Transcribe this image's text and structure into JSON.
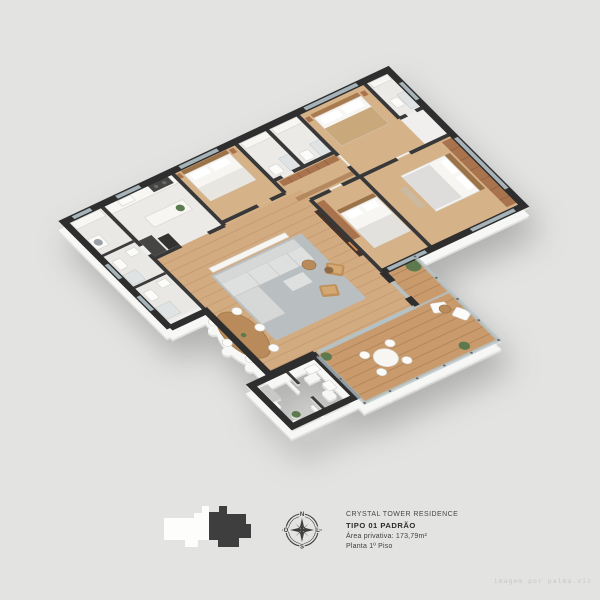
{
  "info": {
    "project": "CRYSTAL TOWER RESIDENCE",
    "unit_type": "TIPO 01 PADRÃO",
    "area": "Área privativa: 173,79m²",
    "floor": "Planta 1º Piso"
  },
  "compass": {
    "north": "N",
    "east": "L",
    "south": "S",
    "west": "O"
  },
  "watermark": "imagem por palma.viz",
  "icons": [
    "keyplan-icon",
    "compass-rose-icon"
  ],
  "palette": {
    "background": "#e3e3e2",
    "wall": "#2e2e2e",
    "wood_floor": "#d6b289",
    "deck": "#c89a6c",
    "tile": "#eceae7",
    "rug": "#b9bec1",
    "glass": "#b4c3c9",
    "cabinet_wood": "#a9744d",
    "plant_green": "#5d7a4e",
    "furniture_white": "#f7f6f3",
    "text_dark": "#2b2b2b",
    "watermark": "#c7c7c5"
  }
}
